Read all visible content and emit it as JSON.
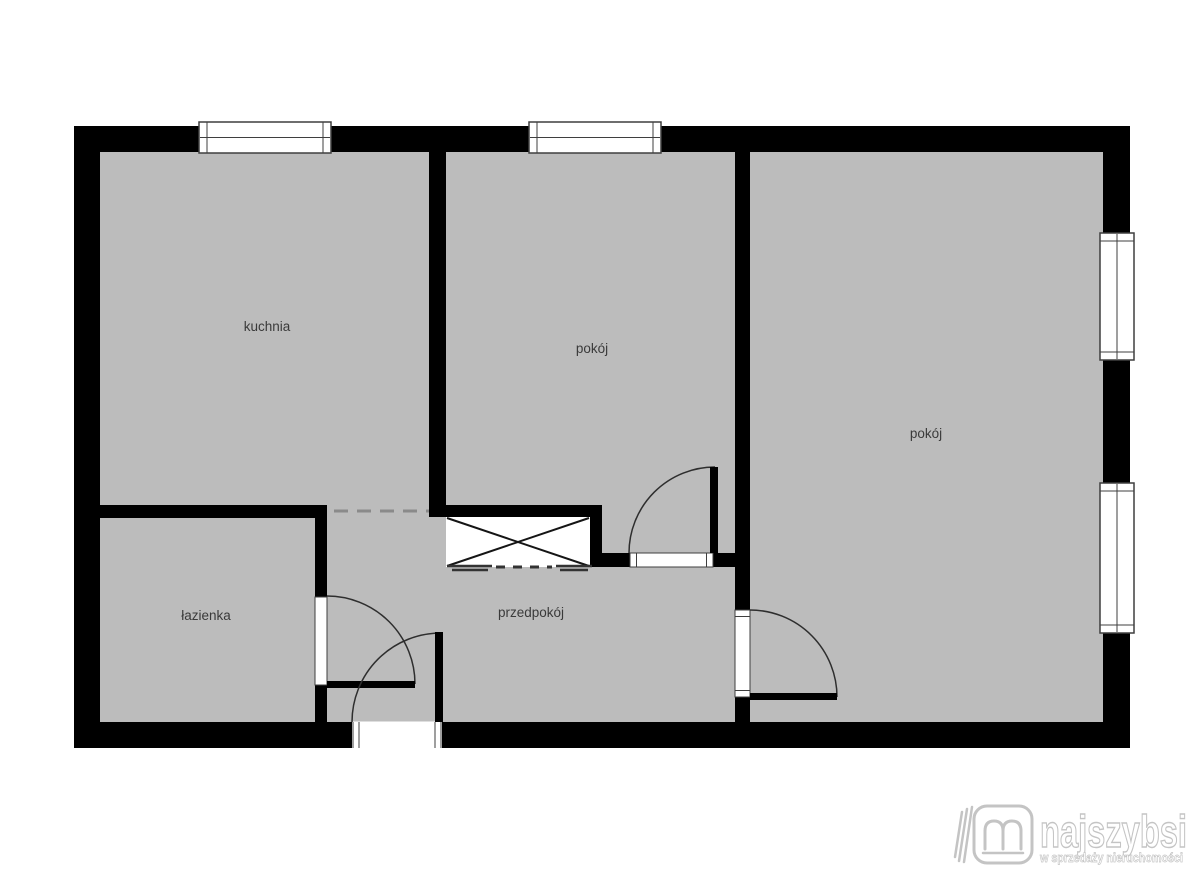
{
  "plan": {
    "title": "apartment-floor-plan",
    "rooms": [
      {
        "id": "kuchnia",
        "label": "kuchnia"
      },
      {
        "id": "pokoj-1",
        "label": "pokój"
      },
      {
        "id": "pokoj-2",
        "label": "pokój"
      },
      {
        "id": "lazienka",
        "label": "łazienka"
      },
      {
        "id": "przedpokoj",
        "label": "przedpokój"
      }
    ],
    "symbols": {
      "window": "window-symbol",
      "door_swing": "door-swing-arc-symbol",
      "wardrobe": "crossed-wardrobe-box-symbol",
      "sliding_door": "dashed-sliding-door-symbol",
      "open_passage": "dashed-opening-symbol"
    },
    "colors": {
      "background": "#ffffff",
      "floor": "#bcbcbc",
      "wall": "#000000",
      "frame_line": "#3f3f3f",
      "arc_line": "#2e2e2e",
      "dash_line": "#8a8a8a",
      "label_text": "#3a3a3a",
      "watermark": "#c4c4c4"
    }
  },
  "watermark": {
    "brand": "najszybsi",
    "tagline": "w sprzedaży nieruchomości",
    "icon": "najszybsi-book-logo-icon"
  }
}
